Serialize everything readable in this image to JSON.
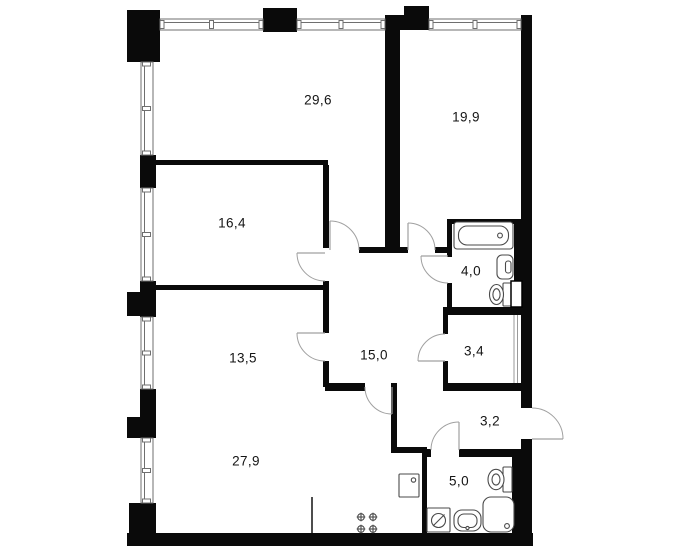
{
  "canvas": {
    "width": 685,
    "height": 550,
    "background": "#ffffff"
  },
  "colors": {
    "wall": "#0a0a0a",
    "window_stroke": "#6f6f6f",
    "door_arc": "#a0a0a0",
    "fixture_stroke": "#4a4a4a",
    "label": "#141414"
  },
  "rooms": [
    {
      "id": "room-29-6",
      "area_label": "29,6",
      "label_x": 318,
      "label_y": 100
    },
    {
      "id": "room-19-9",
      "area_label": "19,9",
      "label_x": 466,
      "label_y": 117
    },
    {
      "id": "room-16-4",
      "area_label": "16,4",
      "label_x": 232,
      "label_y": 223
    },
    {
      "id": "room-4-0",
      "area_label": "4,0",
      "label_x": 471,
      "label_y": 271
    },
    {
      "id": "room-13-5",
      "area_label": "13,5",
      "label_x": 243,
      "label_y": 358
    },
    {
      "id": "room-15-0",
      "area_label": "15,0",
      "label_x": 374,
      "label_y": 355
    },
    {
      "id": "room-3-4",
      "area_label": "3,4",
      "label_x": 474,
      "label_y": 351
    },
    {
      "id": "room-3-2",
      "area_label": "3,2",
      "label_x": 490,
      "label_y": 421
    },
    {
      "id": "room-27-9",
      "area_label": "27,9",
      "label_x": 246,
      "label_y": 461
    },
    {
      "id": "room-5-0",
      "area_label": "5,0",
      "label_x": 459,
      "label_y": 481
    }
  ],
  "walls": [
    {
      "x": 127,
      "y": 10,
      "w": 33,
      "h": 52
    },
    {
      "x": 263,
      "y": 8,
      "w": 34,
      "h": 24
    },
    {
      "x": 404,
      "y": 6,
      "w": 25,
      "h": 24
    },
    {
      "x": 385,
      "y": 15,
      "w": 44,
      "h": 15
    },
    {
      "x": 385,
      "y": 15,
      "w": 15,
      "h": 235
    },
    {
      "x": 521,
      "y": 15,
      "w": 11,
      "h": 393
    },
    {
      "x": 521,
      "y": 439,
      "w": 11,
      "h": 107
    },
    {
      "x": 127,
      "y": 533,
      "w": 406,
      "h": 13
    },
    {
      "x": 129,
      "y": 503,
      "w": 27,
      "h": 42
    },
    {
      "x": 140,
      "y": 155,
      "w": 16,
      "h": 33
    },
    {
      "x": 140,
      "y": 281,
      "w": 16,
      "h": 36
    },
    {
      "x": 127,
      "y": 292,
      "w": 13,
      "h": 24
    },
    {
      "x": 140,
      "y": 389,
      "w": 16,
      "h": 49
    },
    {
      "x": 127,
      "y": 417,
      "w": 13,
      "h": 21
    },
    {
      "x": 155,
      "y": 160,
      "w": 173,
      "h": 5
    },
    {
      "x": 155,
      "y": 285,
      "w": 173,
      "h": 5
    },
    {
      "x": 323,
      "y": 165,
      "w": 6,
      "h": 83
    },
    {
      "x": 323,
      "y": 281,
      "w": 6,
      "h": 9
    },
    {
      "x": 323,
      "y": 290,
      "w": 6,
      "h": 43
    },
    {
      "x": 323,
      "y": 361,
      "w": 6,
      "h": 26
    },
    {
      "x": 359,
      "y": 247,
      "w": 49,
      "h": 6
    },
    {
      "x": 435,
      "y": 247,
      "w": 17,
      "h": 6
    },
    {
      "x": 447,
      "y": 219,
      "w": 74,
      "h": 5
    },
    {
      "x": 447,
      "y": 219,
      "w": 5,
      "h": 38
    },
    {
      "x": 447,
      "y": 283,
      "w": 5,
      "h": 27
    },
    {
      "x": 443,
      "y": 307,
      "w": 89,
      "h": 8
    },
    {
      "x": 514,
      "y": 219,
      "w": 8,
      "h": 88
    },
    {
      "x": 443,
      "y": 315,
      "w": 5,
      "h": 19
    },
    {
      "x": 443,
      "y": 361,
      "w": 5,
      "h": 22
    },
    {
      "x": 325,
      "y": 383,
      "w": 40,
      "h": 8
    },
    {
      "x": 443,
      "y": 383,
      "w": 89,
      "h": 8
    },
    {
      "x": 391,
      "y": 383,
      "w": 6,
      "h": 70
    },
    {
      "x": 391,
      "y": 447,
      "w": 36,
      "h": 6
    },
    {
      "x": 422,
      "y": 449,
      "w": 9,
      "h": 8
    },
    {
      "x": 459,
      "y": 449,
      "w": 71,
      "h": 8
    },
    {
      "x": 422,
      "y": 453,
      "w": 5,
      "h": 80
    },
    {
      "x": 512,
      "y": 457,
      "w": 9,
      "h": 76
    }
  ],
  "windows": [
    {
      "name": "window-top-1",
      "x": 160,
      "y": 19,
      "w": 103,
      "h": 11,
      "orient": "h"
    },
    {
      "name": "window-top-2",
      "x": 297,
      "y": 19,
      "w": 88,
      "h": 11,
      "orient": "h"
    },
    {
      "name": "window-top-3",
      "x": 429,
      "y": 19,
      "w": 92,
      "h": 11,
      "orient": "h"
    },
    {
      "name": "window-left-1",
      "x": 141,
      "y": 62,
      "w": 12,
      "h": 93,
      "orient": "v"
    },
    {
      "name": "window-left-2",
      "x": 141,
      "y": 188,
      "w": 12,
      "h": 93,
      "orient": "v"
    },
    {
      "name": "window-left-3",
      "x": 141,
      "y": 317,
      "w": 12,
      "h": 72,
      "orient": "v"
    },
    {
      "name": "window-left-4",
      "x": 141,
      "y": 438,
      "w": 12,
      "h": 65,
      "orient": "v"
    }
  ],
  "doors": [
    {
      "name": "door-room-29-6",
      "arc": "M359,250 A29 29 0 0 0 330,221",
      "leaf": "M330,250 L330,221"
    },
    {
      "name": "door-room-19-9",
      "arc": "M435,250 A27 27 0 0 0 408,223",
      "leaf": "M408,250 L408,223"
    },
    {
      "name": "door-bathroom",
      "arc": "M448,283 A27 27 0 0 1 421,256",
      "leaf": "M448,256 L421,256"
    },
    {
      "name": "door-room-16-4",
      "arc": "M325,281 A28 28 0 0 1 297,253",
      "leaf": "M325,253 L297,253"
    },
    {
      "name": "door-room-13-5",
      "arc": "M325,361 A28 28 0 0 1 297,333",
      "leaf": "M325,333 L297,333"
    },
    {
      "name": "door-room-27-9",
      "arc": "M365,387 A27 27 0 0 0 392,414",
      "leaf": "M392,387 L392,414"
    },
    {
      "name": "door-room-3-4",
      "arc": "M445,334 A27 27 0 0 0 418,361",
      "leaf": "M445,361 L418,361"
    },
    {
      "name": "door-room-5-0",
      "arc": "M431,450 A28 28 0 0 1 459,422",
      "leaf": "M459,450 L459,422"
    },
    {
      "name": "door-entrance",
      "arc": "M532,408 A31 31 0 0 1 563,439",
      "leaf": "M532,439 L563,439"
    }
  ],
  "lines": [
    {
      "name": "kitchen-partition-line",
      "d": "M312,497 L312,533",
      "w": 1.6,
      "color": "#222222"
    },
    {
      "name": "shaft-line",
      "d": "M514,315 L514,383",
      "w": 1,
      "color": "#9a9a9a"
    },
    {
      "name": "shaft-line",
      "d": "M517.5,315 L517.5,383",
      "w": 1,
      "color": "#9a9a9a"
    }
  ],
  "fixtures": [
    {
      "name": "bathtub",
      "parts": [
        {
          "t": "rect",
          "x": 454,
          "y": 222,
          "w": 59,
          "h": 27,
          "r": 3
        },
        {
          "t": "rect",
          "x": 458.5,
          "y": 226,
          "w": 50,
          "h": 19,
          "r": 8.5
        },
        {
          "t": "circle",
          "cx": 500,
          "cy": 235.5,
          "rr": 2.4
        }
      ]
    },
    {
      "name": "sink-bathroom",
      "parts": [
        {
          "t": "rect",
          "x": 497,
          "y": 255,
          "w": 16,
          "h": 24,
          "r": 5
        },
        {
          "t": "rect",
          "x": 505.5,
          "y": 261,
          "w": 5.5,
          "h": 12,
          "r": 2.5
        }
      ]
    },
    {
      "name": "toilet-bathroom",
      "parts": [
        {
          "t": "rect",
          "x": 503,
          "y": 283,
          "w": 10,
          "h": 23,
          "r": 1
        },
        {
          "t": "ellipse",
          "cx": 496.5,
          "cy": 294.5,
          "rx": 7,
          "ry": 10
        },
        {
          "t": "ellipse",
          "cx": 496.5,
          "cy": 294.5,
          "rx": 3.6,
          "ry": 5.8
        }
      ]
    },
    {
      "name": "duct-box",
      "stroke": "#000000",
      "sw": 1.5,
      "parts": [
        {
          "t": "rect",
          "x": 511,
          "y": 281,
          "w": 11,
          "h": 26,
          "r": 0
        }
      ]
    },
    {
      "name": "washing-machine",
      "parts": [
        {
          "t": "rect",
          "x": 427,
          "y": 508,
          "w": 23,
          "h": 24,
          "r": 1
        },
        {
          "t": "circle",
          "cx": 438.5,
          "cy": 520.5,
          "rr": 7
        },
        {
          "t": "line",
          "x1": 433,
          "y1": 526,
          "x2": 444.5,
          "y2": 514.5
        }
      ]
    },
    {
      "name": "sink-shower-room",
      "parts": [
        {
          "t": "rect",
          "x": 454,
          "y": 510,
          "w": 27,
          "h": 21,
          "r": 8
        },
        {
          "t": "rect",
          "x": 458,
          "y": 514,
          "w": 19,
          "h": 13.5,
          "r": 6
        },
        {
          "t": "circle",
          "cx": 467.5,
          "cy": 528,
          "rr": 1.6
        }
      ]
    },
    {
      "name": "shower",
      "parts": [
        {
          "t": "rect",
          "x": 483,
          "y": 497,
          "w": 31,
          "h": 35,
          "r": 8
        },
        {
          "t": "circle",
          "cx": 507,
          "cy": 526,
          "rr": 2.4
        }
      ]
    },
    {
      "name": "toilet-shower-room",
      "parts": [
        {
          "t": "rect",
          "x": 503,
          "y": 467,
          "w": 9,
          "h": 25,
          "r": 1
        },
        {
          "t": "ellipse",
          "cx": 496,
          "cy": 479.5,
          "rx": 8,
          "ry": 10.2
        },
        {
          "t": "ellipse",
          "cx": 496,
          "cy": 479.5,
          "rx": 4,
          "ry": 5.6
        }
      ]
    },
    {
      "name": "kitchen-sink",
      "parts": [
        {
          "t": "rect",
          "x": 399,
          "y": 474,
          "w": 20,
          "h": 23,
          "r": 1
        },
        {
          "t": "circle",
          "cx": 413.5,
          "cy": 480,
          "rr": 2.2
        }
      ]
    },
    {
      "name": "stove",
      "parts": [
        {
          "t": "circle",
          "cx": 361,
          "cy": 517,
          "rr": 3.3
        },
        {
          "t": "line",
          "x1": 356.7,
          "y1": 517,
          "x2": 365.3,
          "y2": 517
        },
        {
          "t": "line",
          "x1": 361,
          "y1": 512.7,
          "x2": 361,
          "y2": 521.3
        },
        {
          "t": "circle",
          "cx": 373,
          "cy": 517,
          "rr": 3.3
        },
        {
          "t": "line",
          "x1": 368.7,
          "y1": 517,
          "x2": 377.3,
          "y2": 517
        },
        {
          "t": "line",
          "x1": 373,
          "y1": 512.7,
          "x2": 373,
          "y2": 521.3
        },
        {
          "t": "circle",
          "cx": 361,
          "cy": 529,
          "rr": 3.3
        },
        {
          "t": "line",
          "x1": 356.7,
          "y1": 529,
          "x2": 365.3,
          "y2": 529
        },
        {
          "t": "line",
          "x1": 361,
          "y1": 524.7,
          "x2": 361,
          "y2": 533.3
        },
        {
          "t": "circle",
          "cx": 373,
          "cy": 529,
          "rr": 3.3
        },
        {
          "t": "line",
          "x1": 368.7,
          "y1": 529,
          "x2": 377.3,
          "y2": 529
        },
        {
          "t": "line",
          "x1": 373,
          "y1": 524.7,
          "x2": 373,
          "y2": 533.3
        }
      ]
    }
  ]
}
